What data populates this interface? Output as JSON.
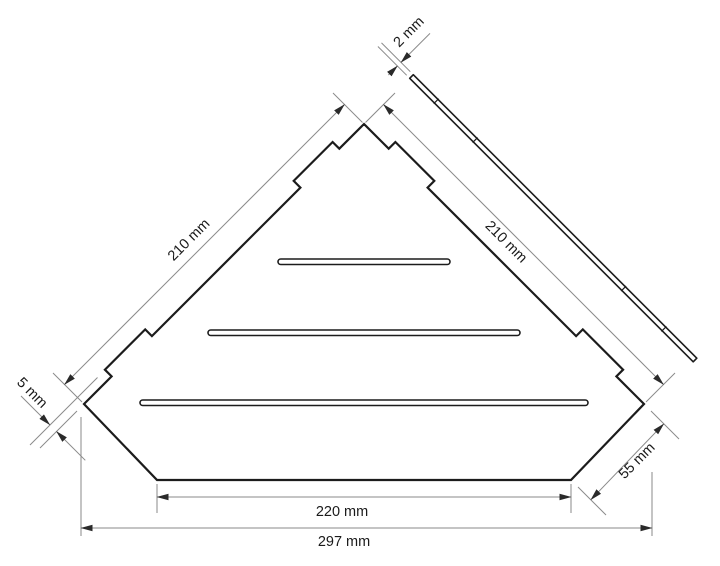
{
  "drawing": {
    "kind": "technical dimension drawing",
    "views": [
      "top view of corner shelf",
      "side profile bar"
    ],
    "colors": {
      "outline": "#1c1c1c",
      "dimension_lines": "#8a8a8a",
      "background": "#ffffff",
      "text": "#1a1a1a"
    },
    "labels": {
      "left_edge": "210 mm",
      "right_edge": "210 mm",
      "thickness": "2 mm",
      "step": "5 mm",
      "chamfer": "55 mm",
      "inner_width": "220 mm",
      "overall_width": "297 mm"
    }
  }
}
